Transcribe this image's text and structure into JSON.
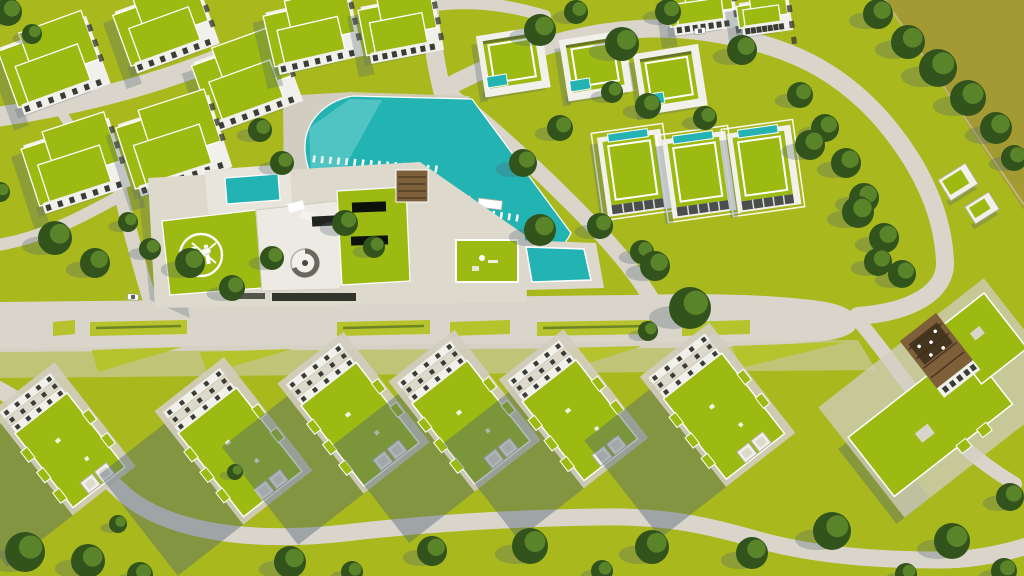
{
  "scene": {
    "type": "aerial-3d-render",
    "description": "Aerial top-down 3D architectural rendering of a resort-style residential master plan: green-roofed apartment blocks and villas, a turquoise lagoon pool, a clubhouse with rooftop helipad, tree-lined boulevard and winding perimeter roads",
    "helipad_letter": "H"
  },
  "palette": {
    "grass": "#a9b81d",
    "grass_light": "#b6c32c",
    "field": "#a49a33",
    "road": "#dad5cb",
    "sidewalk": "#d2cdc1",
    "roof_green": "#9cba12",
    "white": "#f2f0ea",
    "facade": "#ddd9cd",
    "facade_dark": "#b4afa2",
    "window": "#3a3c36",
    "skylight": "#0d110c",
    "pool": "#24b3b3",
    "pool_light": "#8edcd8",
    "tree": "#33531d",
    "tree_light": "#5d8a2b",
    "shadow": "#4e6472",
    "timber": "#7d5f3a",
    "hedge": "#31352c",
    "helipad_mark": "#ffffff"
  },
  "roads": [
    {
      "name": "road-topleft-diagonal",
      "d": "M350,-10 C270,45 150,95 -10,118",
      "w": 20
    },
    {
      "name": "road-top-vertical",
      "d": "M428,-10 C430,25 434,58 442,90",
      "w": 18
    },
    {
      "name": "road-top-edge",
      "d": "M428,6 C470,0 505,4 545,16",
      "w": 12
    },
    {
      "name": "road-villas-loop",
      "d": "M442,90 C520,48 610,18 705,32 C790,44 838,72 878,115 C918,160 943,210 945,262 C946,292 912,312 858,316",
      "w": 18
    },
    {
      "name": "road-lagoon-east",
      "d": "M442,90 C468,106 520,152 572,204 C602,234 632,266 652,300",
      "w": 16
    },
    {
      "name": "road-clubhouse-west",
      "d": "M118,182 C128,225 140,268 152,308",
      "w": 14
    },
    {
      "name": "road-park-link",
      "d": "M60,110 C85,150 102,168 118,186",
      "w": 10
    },
    {
      "name": "road-left-connector",
      "d": "M-8,246 C45,238 85,215 120,196",
      "w": 12
    },
    {
      "name": "road-bottom-winding",
      "d": "M-10,385 C50,415 85,460 125,495 C170,533 255,543 345,533 C430,523 520,518 600,517 C660,516 700,523 755,539 C815,556 880,560 940,560 C975,560 1005,553 1030,545",
      "w": 17
    },
    {
      "name": "road-southeast-branch",
      "d": "M856,318 C880,345 900,375 922,403 C945,432 975,460 1015,484",
      "w": 14
    }
  ],
  "boulevard": {
    "d": "M0,302 L630,295 C700,293 760,294 812,300 C840,303 856,310 857,322 C858,334 840,340 812,342 C760,347 700,348 630,348 L0,352 Z"
  },
  "sidewalk_band": {
    "d": "M0,348 L858,340 L876,370 L0,378 Z"
  },
  "medians": [
    [
      53,
      75
    ],
    [
      90,
      187
    ],
    [
      337,
      430
    ],
    [
      450,
      510
    ],
    [
      537,
      652
    ],
    [
      682,
      750
    ]
  ],
  "plaza_triangles": [
    [
      [
        92,
        350
      ],
      [
        182,
        347
      ],
      [
        98,
        372
      ]
    ],
    [
      [
        200,
        352
      ],
      [
        292,
        349
      ],
      [
        207,
        374
      ]
    ],
    [
      [
        560,
        348
      ],
      [
        642,
        346
      ],
      [
        567,
        370
      ]
    ],
    [
      [
        732,
        346
      ],
      [
        846,
        342
      ],
      [
        741,
        368
      ]
    ]
  ],
  "pool": {
    "d": "M352,96 C322,102 304,124 305,149 C306,174 319,194 341,206 L524,267 C548,261 564,248 571,233 L472,99 Z",
    "shallow_points": "309,128 350,99 382,100 332,190 311,172"
  },
  "lounger_rows": [
    {
      "x1": 314,
      "y1": 159,
      "x2": 436,
      "y2": 169,
      "n": 16
    },
    {
      "x1": 398,
      "y1": 201,
      "x2": 436,
      "y2": 206,
      "n": 6
    },
    {
      "x1": 446,
      "y1": 207,
      "x2": 517,
      "y2": 218,
      "n": 10
    }
  ],
  "canopies": [
    {
      "x": 458,
      "y": 199,
      "rot": 7
    },
    {
      "x": 490,
      "y": 204,
      "rot": 7
    }
  ],
  "apartments": [
    {
      "x": 50,
      "y": 60,
      "rot": -20,
      "w": 92,
      "h": 72
    },
    {
      "x": 162,
      "y": 22,
      "rot": -20,
      "w": 88,
      "h": 66
    },
    {
      "x": 243,
      "y": 76,
      "rot": -20,
      "w": 90,
      "h": 74
    },
    {
      "x": 72,
      "y": 160,
      "rot": -18,
      "w": 90,
      "h": 72
    },
    {
      "x": 170,
      "y": 140,
      "rot": -18,
      "w": 96,
      "h": 76
    },
    {
      "x": 310,
      "y": 28,
      "rot": -13,
      "w": 86,
      "h": 64
    },
    {
      "x": 398,
      "y": 22,
      "rot": -11,
      "w": 74,
      "h": 58
    },
    {
      "x": 700,
      "y": 4,
      "rot": -8,
      "w": 64,
      "h": 42
    },
    {
      "x": 762,
      "y": 10,
      "rot": -8,
      "w": 50,
      "h": 34
    }
  ],
  "villas_row1": {
    "size": {
      "w": 62,
      "h": 58,
      "rot": -9
    },
    "items": [
      {
        "x": 511,
        "y": 60
      },
      {
        "x": 594,
        "y": 64
      },
      {
        "x": 668,
        "y": 78
      }
    ]
  },
  "villas_row2": {
    "size": {
      "w": 62,
      "h": 78,
      "rot": -8
    },
    "items": [
      {
        "x": 633,
        "y": 172
      },
      {
        "x": 698,
        "y": 174
      },
      {
        "x": 763,
        "y": 168
      }
    ]
  },
  "terraces": {
    "rot": -38,
    "items": [
      {
        "x": 62,
        "y": 440,
        "w": 66,
        "h": 120
      },
      {
        "x": 232,
        "y": 442,
        "w": 74,
        "h": 132
      },
      {
        "x": 352,
        "y": 414,
        "w": 70,
        "h": 128
      },
      {
        "x": 463,
        "y": 412,
        "w": 70,
        "h": 128
      },
      {
        "x": 572,
        "y": 410,
        "w": 68,
        "h": 126
      },
      {
        "x": 716,
        "y": 406,
        "w": 74,
        "h": 128
      }
    ]
  },
  "gatehouses": [
    {
      "x": 958,
      "y": 182,
      "w": 32,
      "h": 24,
      "rot": -32
    },
    {
      "x": 982,
      "y": 208,
      "w": 28,
      "h": 20,
      "rot": -32
    }
  ],
  "cars": [
    {
      "x": 133,
      "y": 297,
      "rot": 4
    },
    {
      "x": 700,
      "y": 31,
      "rot": -6
    }
  ],
  "trees": [
    [
      878,
      14,
      15
    ],
    [
      908,
      42,
      17
    ],
    [
      938,
      68,
      19
    ],
    [
      968,
      98,
      18
    ],
    [
      996,
      128,
      16
    ],
    [
      1014,
      158,
      13
    ],
    [
      540,
      30,
      16
    ],
    [
      576,
      12,
      12
    ],
    [
      622,
      44,
      17
    ],
    [
      668,
      12,
      13
    ],
    [
      742,
      50,
      15
    ],
    [
      800,
      95,
      13
    ],
    [
      825,
      128,
      14
    ],
    [
      846,
      163,
      15
    ],
    [
      864,
      198,
      15
    ],
    [
      884,
      238,
      15
    ],
    [
      902,
      274,
      14
    ],
    [
      612,
      92,
      11
    ],
    [
      648,
      106,
      13
    ],
    [
      705,
      118,
      12
    ],
    [
      560,
      128,
      13
    ],
    [
      523,
      163,
      14
    ],
    [
      600,
      226,
      13
    ],
    [
      642,
      252,
      12
    ],
    [
      540,
      230,
      16
    ],
    [
      655,
      266,
      15
    ],
    [
      810,
      145,
      15
    ],
    [
      858,
      212,
      16
    ],
    [
      878,
      262,
      14
    ],
    [
      690,
      308,
      21
    ],
    [
      648,
      331,
      10
    ],
    [
      55,
      238,
      17
    ],
    [
      95,
      263,
      15
    ],
    [
      150,
      249,
      11
    ],
    [
      190,
      263,
      15
    ],
    [
      232,
      288,
      13
    ],
    [
      272,
      258,
      12
    ],
    [
      128,
      222,
      10
    ],
    [
      8,
      12,
      14
    ],
    [
      32,
      34,
      10
    ],
    [
      260,
      130,
      12
    ],
    [
      282,
      163,
      12
    ],
    [
      345,
      223,
      13
    ],
    [
      374,
      247,
      11
    ],
    [
      0,
      192,
      10
    ],
    [
      25,
      552,
      20
    ],
    [
      88,
      561,
      17
    ],
    [
      140,
      575,
      13
    ],
    [
      290,
      562,
      16
    ],
    [
      352,
      572,
      11
    ],
    [
      432,
      551,
      15
    ],
    [
      530,
      546,
      18
    ],
    [
      602,
      571,
      11
    ],
    [
      652,
      547,
      17
    ],
    [
      752,
      553,
      16
    ],
    [
      832,
      531,
      19
    ],
    [
      952,
      541,
      18
    ],
    [
      1010,
      497,
      14
    ],
    [
      1004,
      571,
      13
    ],
    [
      906,
      574,
      11
    ],
    [
      235,
      472,
      8
    ],
    [
      118,
      524,
      9
    ]
  ],
  "hedge_dots": {
    "x": 294,
    "y_start": 110,
    "step": 20,
    "count": 5,
    "r": 5
  }
}
